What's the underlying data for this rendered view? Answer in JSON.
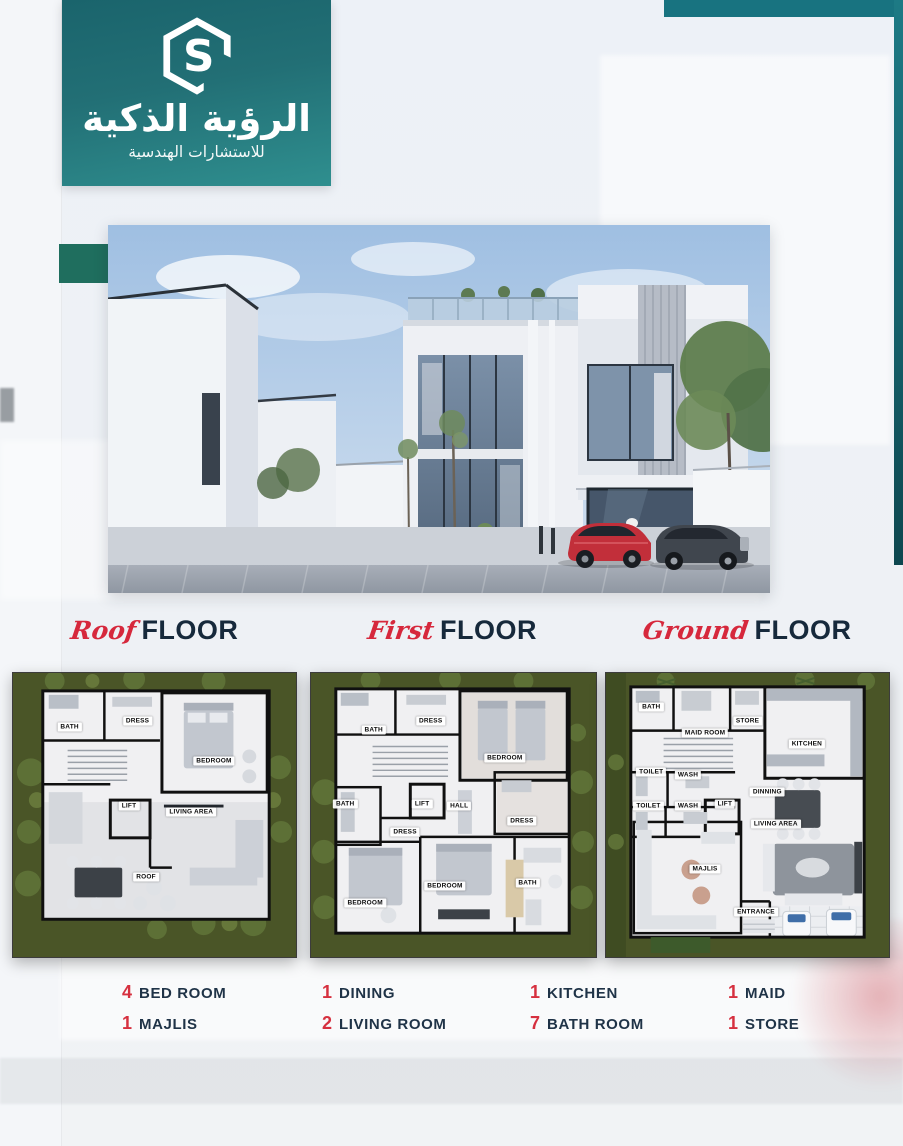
{
  "brand": {
    "name_ar": "الرؤية الذكية",
    "tagline_ar": "للاستشارات الهندسية",
    "monogram": "S"
  },
  "floor_titles": [
    {
      "script": "Roof",
      "word": "FLOOR"
    },
    {
      "script": "First",
      "word": "FLOOR"
    },
    {
      "script": "Ground",
      "word": "FLOOR"
    }
  ],
  "plans": [
    {
      "id": "roof-floor-plan",
      "rooms": [
        {
          "label": "BATH",
          "x": 20,
          "y": 19
        },
        {
          "label": "DRESS",
          "x": 44,
          "y": 17
        },
        {
          "label": "BEDROOM",
          "x": 71,
          "y": 31
        },
        {
          "label": "LIFT",
          "x": 41,
          "y": 47
        },
        {
          "label": "LIVING AREA",
          "x": 63,
          "y": 49
        },
        {
          "label": "ROOF",
          "x": 47,
          "y": 72
        }
      ]
    },
    {
      "id": "first-floor-plan",
      "rooms": [
        {
          "label": "BATH",
          "x": 22,
          "y": 20
        },
        {
          "label": "DRESS",
          "x": 42,
          "y": 17
        },
        {
          "label": "BEDROOM",
          "x": 68,
          "y": 30
        },
        {
          "label": "BATH",
          "x": 12,
          "y": 46
        },
        {
          "label": "LIFT",
          "x": 39,
          "y": 46
        },
        {
          "label": "HALL",
          "x": 52,
          "y": 47
        },
        {
          "label": "DRESS",
          "x": 33,
          "y": 56
        },
        {
          "label": "DRESS",
          "x": 74,
          "y": 52
        },
        {
          "label": "BEDROOM",
          "x": 19,
          "y": 81
        },
        {
          "label": "BEDROOM",
          "x": 47,
          "y": 75
        },
        {
          "label": "BATH",
          "x": 76,
          "y": 74
        }
      ]
    },
    {
      "id": "ground-floor-plan",
      "rooms": [
        {
          "label": "BATH",
          "x": 16,
          "y": 12
        },
        {
          "label": "MAID ROOM",
          "x": 35,
          "y": 21
        },
        {
          "label": "STORE",
          "x": 50,
          "y": 17
        },
        {
          "label": "KITCHEN",
          "x": 71,
          "y": 25
        },
        {
          "label": "TOILET",
          "x": 16,
          "y": 35
        },
        {
          "label": "WASH",
          "x": 29,
          "y": 36
        },
        {
          "label": "TOILET",
          "x": 15,
          "y": 47
        },
        {
          "label": "WASH",
          "x": 29,
          "y": 47
        },
        {
          "label": "LIFT",
          "x": 42,
          "y": 46
        },
        {
          "label": "DINNING",
          "x": 57,
          "y": 42
        },
        {
          "label": "LIVING AREA",
          "x": 60,
          "y": 53
        },
        {
          "label": "MAJLIS",
          "x": 35,
          "y": 69
        },
        {
          "label": "ENTRANCE",
          "x": 53,
          "y": 84
        }
      ]
    }
  ],
  "stats_columns": [
    [
      {
        "count": "4",
        "label": "BED ROOM"
      },
      {
        "count": "1",
        "label": "MAJLIS"
      }
    ],
    [
      {
        "count": "1",
        "label": "DINING"
      },
      {
        "count": "2",
        "label": "LIVING ROOM"
      }
    ],
    [
      {
        "count": "1",
        "label": "KITCHEN"
      },
      {
        "count": "7",
        "label": "BATH ROOM"
      }
    ],
    [
      {
        "count": "1",
        "label": "MAID"
      },
      {
        "count": "1",
        "label": "STORE"
      }
    ]
  ],
  "colors": {
    "teal_band": "#187380",
    "teal_strip_top": "#1d7a85",
    "teal_strip_bottom": "#0d474f",
    "logo_teal_top": "#1a646c",
    "logo_teal_bottom": "#2f8f8f",
    "green_square": "#1f6e5e",
    "accent_red": "#d6303f",
    "script_red": "#d6283c",
    "navy": "#16293b",
    "plan_grass": "#4a5527"
  }
}
